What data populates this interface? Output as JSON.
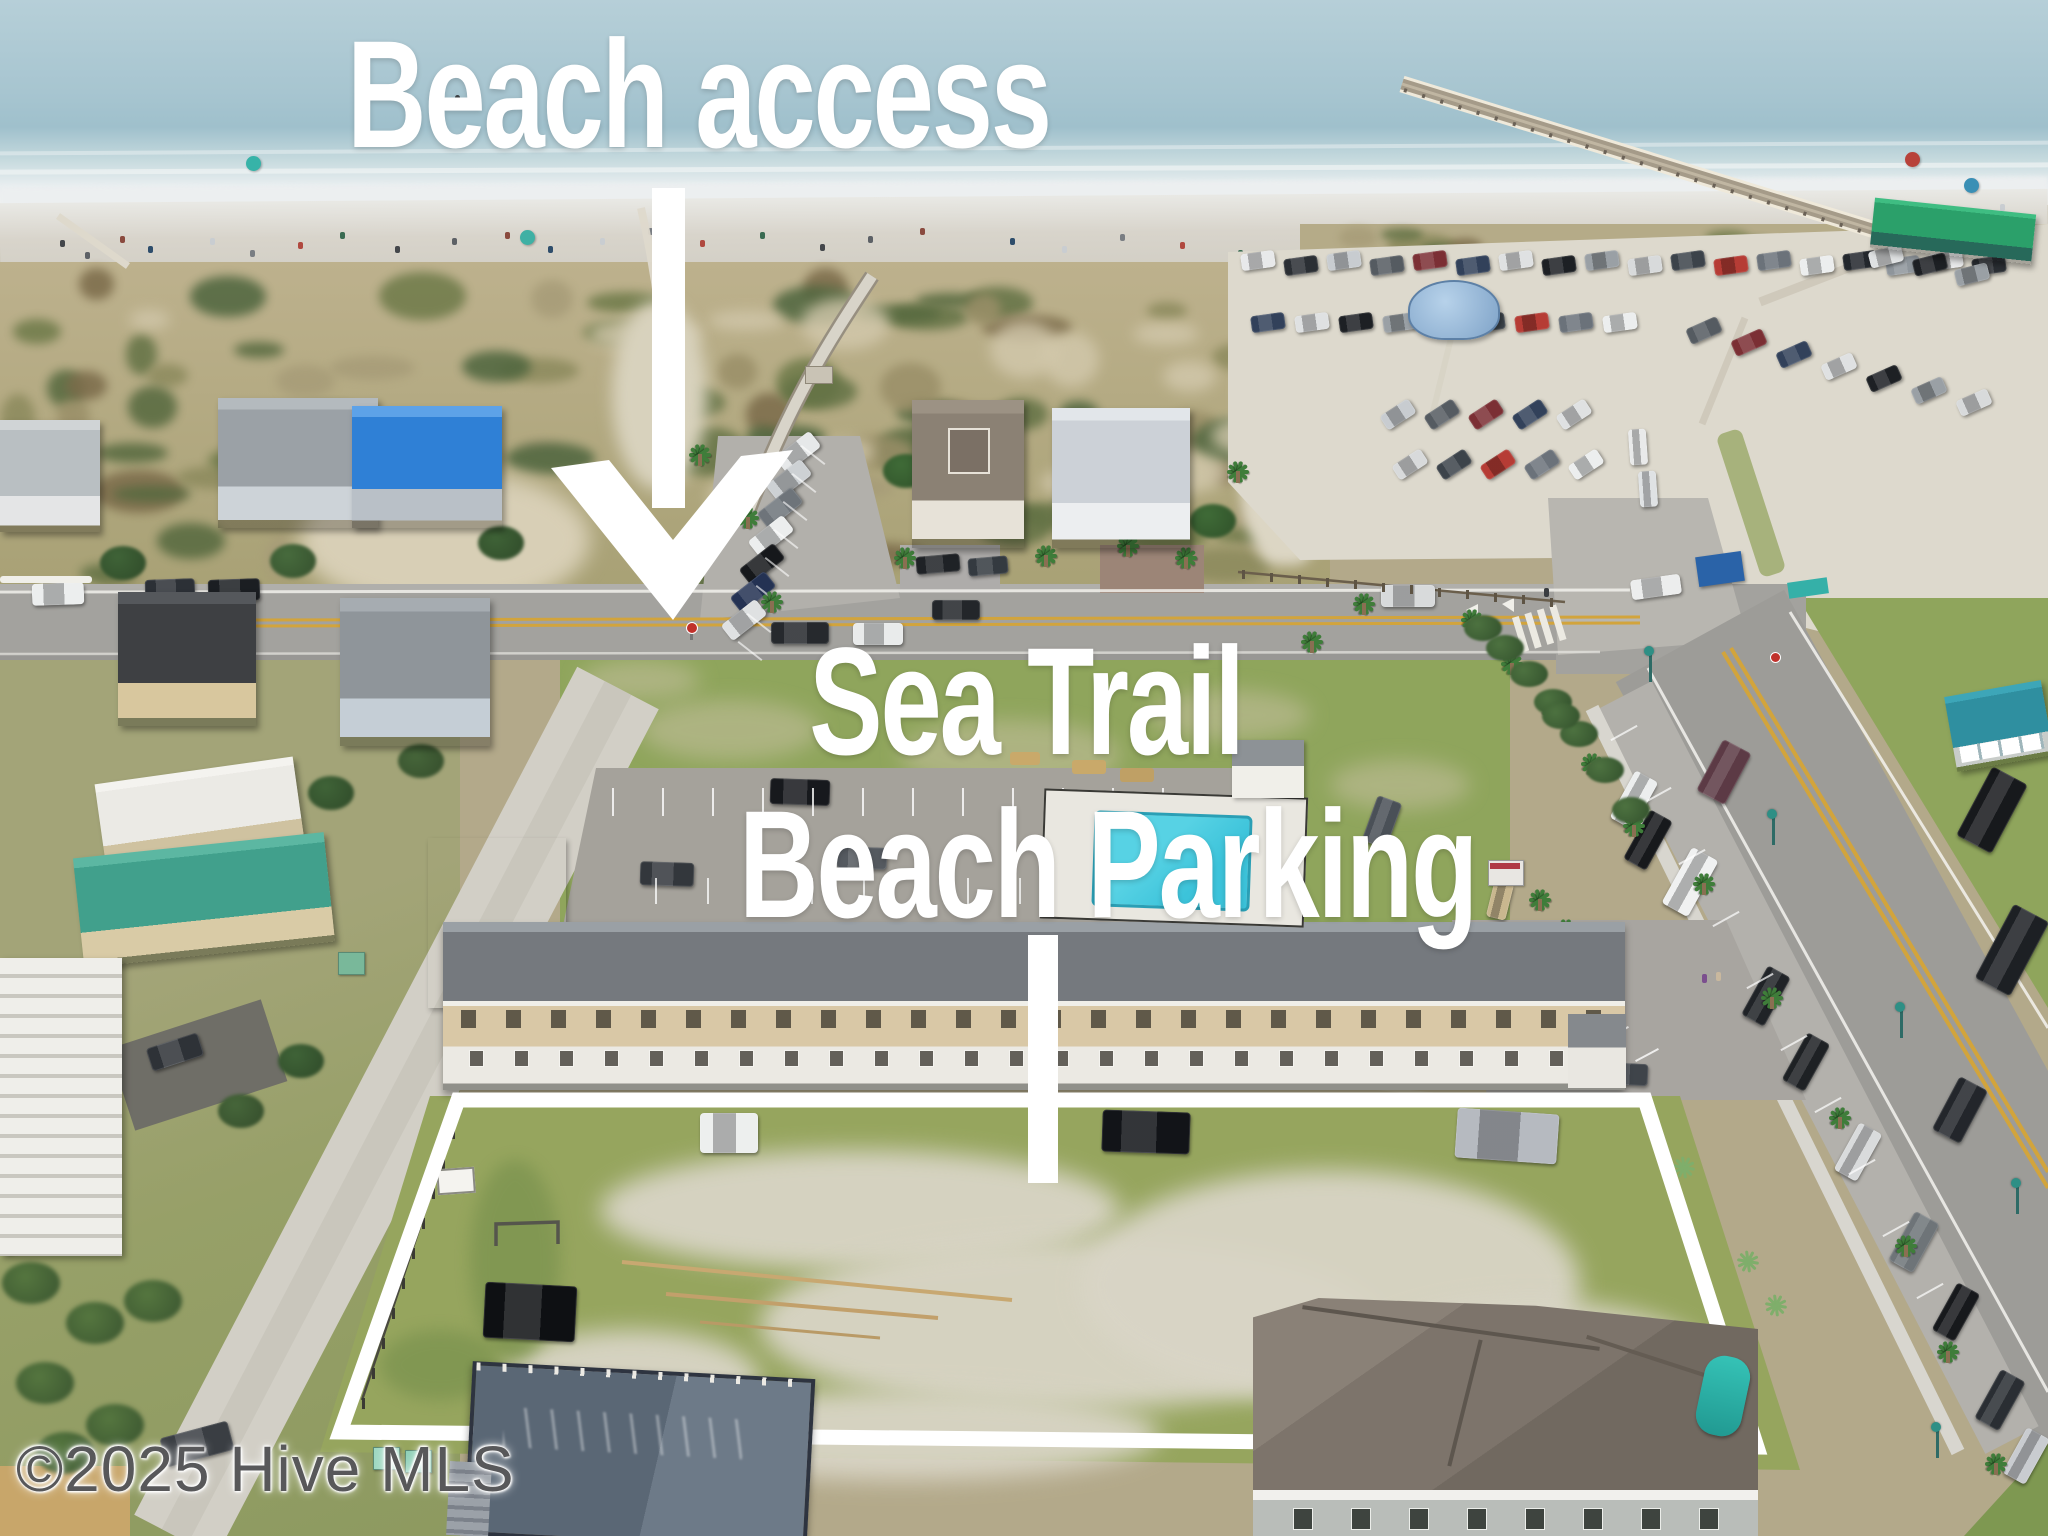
{
  "overlay": {
    "beach_access_label": "Beach access",
    "property_line1": "Sea Trail",
    "property_line2": "Beach Parking",
    "watermark": "©2025 Hive MLS"
  },
  "colors": {
    "overlay_text": "#ffffff",
    "outline": "#ffffff",
    "watermark": "#58585a",
    "ocean": "#aecbd5",
    "surf": "#eceff0",
    "beach_sand": "#d8d4cb",
    "dune": "#b3a98a",
    "scrub_green": "#6e7a49",
    "grass": "#8fa55c",
    "road_asphalt": "#a3a29e",
    "dirt_road": "#d2cfc6",
    "lot_sand": "#ddd9cd",
    "pool_water": "#3cc3da",
    "condo_roof": "#75797e",
    "condo_wall": "#d9c8a6",
    "pier_deck": "#a59b89",
    "pier_house_roof": "#2ba06a",
    "lamp_teal": "#2e8f85",
    "yellow_line": "#d2a43c"
  }
}
